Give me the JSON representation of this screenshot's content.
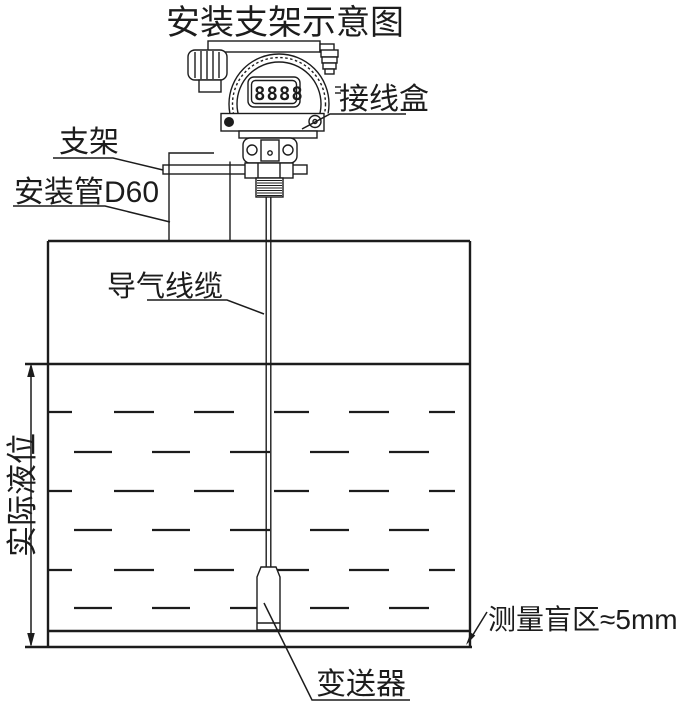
{
  "title": "安装支架示意图",
  "labels": {
    "junction_box": "接线盒",
    "bracket": "支架",
    "mounting_pipe": "安装管D60",
    "air_cable": "导气线缆",
    "actual_level": "实际液位",
    "blind_zone": "测量盲区≈5mm",
    "transmitter": "变送器"
  },
  "device": {
    "lcd_value": "8888"
  },
  "colors": {
    "line": "#1c1c1c",
    "background": "#ffffff"
  }
}
